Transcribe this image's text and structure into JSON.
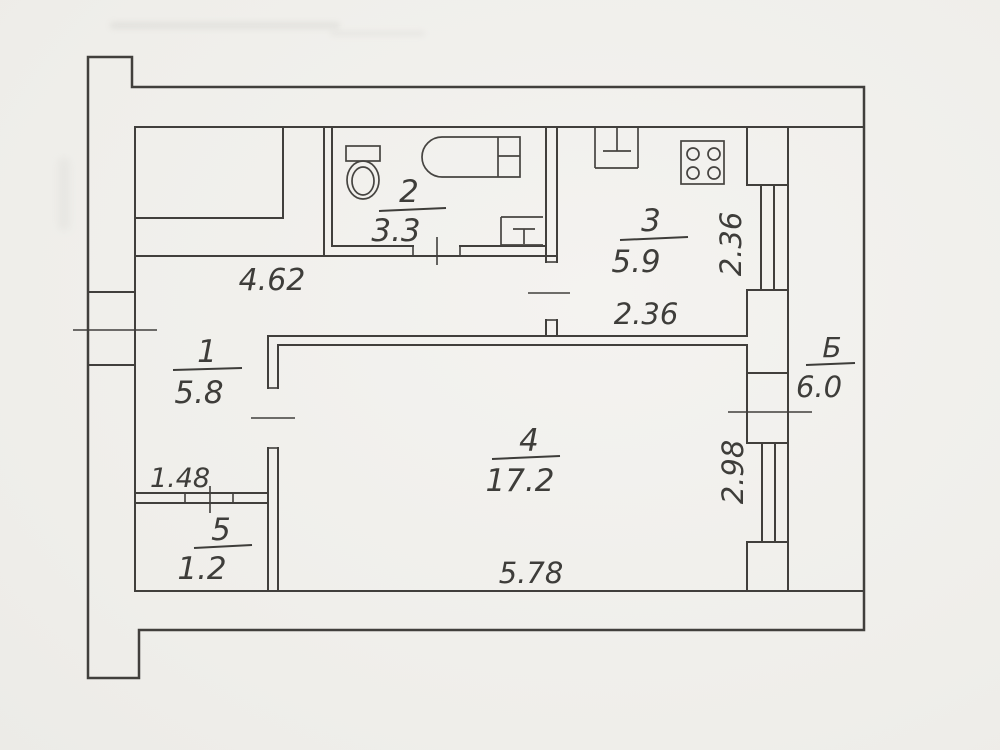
{
  "plan": {
    "type": "apartment-floor-plan-scan",
    "line_color": "#413f3c",
    "paper_color": "#f1f0ed",
    "rooms": [
      {
        "label": "hallway",
        "number": "1",
        "area": "5.8"
      },
      {
        "label": "bathroom",
        "number": "2",
        "area": "3.3"
      },
      {
        "label": "kitchen",
        "number": "3",
        "area": "5.9"
      },
      {
        "label": "living-room",
        "number": "4",
        "area": "17.2"
      },
      {
        "label": "storage",
        "number": "5",
        "area": "1.2"
      },
      {
        "label": "balcony",
        "number": "Б",
        "area": "6.0"
      }
    ],
    "dimensions": {
      "corridor_length": "4.62",
      "kitchen_width": "2.36",
      "kitchen_window_width": "2.36",
      "storage_width": "1.48",
      "living_room_length": "5.78",
      "living_room_window_width": "2.98"
    },
    "fixture_icons": [
      "toilet-icon",
      "bathtub-icon",
      "washbasin-icon",
      "kitchen-sink-icon",
      "stove-icon"
    ]
  }
}
